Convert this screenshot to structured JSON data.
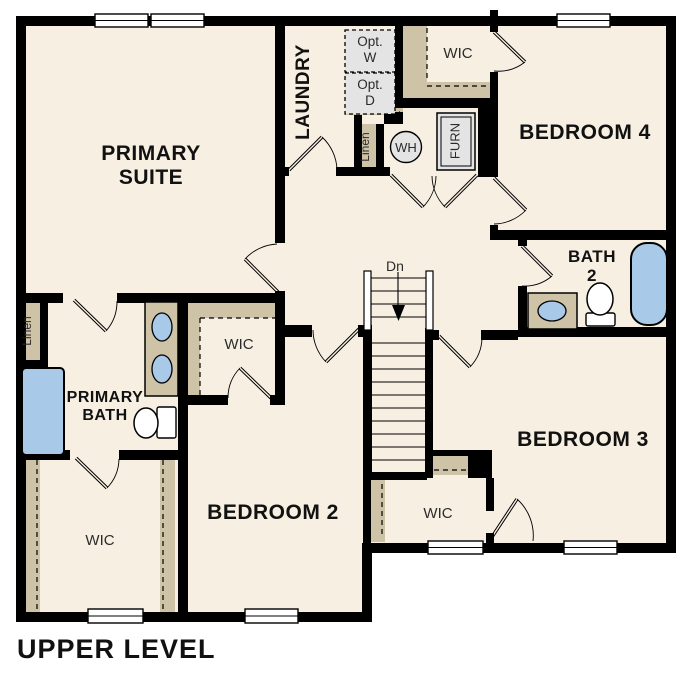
{
  "title": "UPPER LEVEL",
  "canvas": {
    "w": 687,
    "h": 687
  },
  "colors": {
    "floor": "#f7efe2",
    "wall": "#000000",
    "casework": "#cec2a7",
    "fixture_blue": "#a9c9e9",
    "appliance": "#e4e4e4",
    "label_bold": "#111111",
    "label_regular": "#2b2b2b",
    "line": "#000000",
    "white": "#ffffff"
  },
  "plan": {
    "slabs": [
      [
        16,
        16,
        660,
        537
      ],
      [
        16,
        16,
        356,
        606
      ]
    ],
    "walls": [
      [
        16,
        16,
        660,
        10
      ],
      [
        16,
        16,
        10,
        606
      ],
      [
        16,
        612,
        356,
        10
      ],
      [
        666,
        16,
        10,
        537
      ],
      [
        362,
        543,
        314,
        10
      ],
      [
        362,
        543,
        10,
        79
      ],
      [
        275,
        16,
        10,
        227
      ],
      [
        275,
        291,
        10,
        12
      ],
      [
        275,
        167,
        14,
        9
      ],
      [
        336,
        167,
        54,
        9
      ],
      [
        384,
        112,
        19,
        12
      ],
      [
        395,
        23,
        8,
        85
      ],
      [
        354,
        115,
        8,
        61
      ],
      [
        376,
        124,
        8,
        52
      ],
      [
        403,
        98,
        95,
        10
      ],
      [
        490,
        10,
        8,
        22
      ],
      [
        490,
        72,
        8,
        36
      ],
      [
        490,
        108,
        8,
        69
      ],
      [
        490,
        225,
        8,
        15
      ],
      [
        478,
        107,
        14,
        70
      ],
      [
        490,
        230,
        186,
        10
      ],
      [
        518,
        240,
        9,
        6
      ],
      [
        518,
        286,
        9,
        51
      ],
      [
        518,
        327,
        158,
        10
      ],
      [
        425,
        330,
        14,
        10
      ],
      [
        481,
        330,
        37,
        10
      ],
      [
        16,
        293,
        47,
        10
      ],
      [
        117,
        293,
        168,
        10
      ],
      [
        40,
        303,
        8,
        60
      ],
      [
        16,
        360,
        32,
        8
      ],
      [
        16,
        450,
        54,
        10
      ],
      [
        119,
        450,
        69,
        10
      ],
      [
        178,
        293,
        10,
        329
      ],
      [
        275,
        303,
        10,
        102
      ],
      [
        188,
        395,
        40,
        10
      ],
      [
        270,
        395,
        13,
        10
      ],
      [
        285,
        325,
        27,
        12
      ],
      [
        358,
        325,
        14,
        12
      ],
      [
        363,
        328,
        9,
        150
      ],
      [
        425,
        328,
        8,
        150
      ],
      [
        365,
        472,
        62,
        8
      ],
      [
        432,
        450,
        60,
        6
      ],
      [
        468,
        452,
        24,
        26
      ],
      [
        363,
        478,
        8,
        75
      ],
      [
        486,
        478,
        8,
        33
      ],
      [
        486,
        533,
        8,
        10
      ]
    ],
    "windows": [
      [
        95,
        14,
        53,
        13
      ],
      [
        151,
        14,
        53,
        13
      ],
      [
        557,
        14,
        53,
        13
      ],
      [
        88,
        609,
        55,
        14
      ],
      [
        245,
        609,
        53,
        14
      ],
      [
        428,
        541,
        55,
        13
      ],
      [
        564,
        541,
        53,
        13
      ]
    ],
    "casework": [
      [
        22,
        303,
        18,
        57
      ],
      [
        362,
        124,
        14,
        46
      ],
      [
        403,
        23,
        24,
        80
      ],
      [
        403,
        82,
        89,
        21
      ],
      [
        188,
        303,
        87,
        15
      ],
      [
        188,
        303,
        12,
        94
      ],
      [
        26,
        455,
        14,
        157
      ],
      [
        160,
        455,
        15,
        157
      ],
      [
        371,
        480,
        14,
        62
      ],
      [
        432,
        456,
        36,
        19
      ],
      [
        345,
        106,
        58,
        9
      ]
    ],
    "dashed": [
      [
        427,
        28,
        427,
        80
      ],
      [
        427,
        86,
        492,
        86
      ],
      [
        200,
        318,
        275,
        318
      ],
      [
        200,
        318,
        200,
        395
      ],
      [
        37,
        460,
        37,
        610
      ],
      [
        163,
        460,
        163,
        610
      ],
      [
        382,
        484,
        382,
        538
      ],
      [
        434,
        470,
        466,
        470
      ],
      [
        345,
        112,
        400,
        112
      ]
    ],
    "doors": [
      {
        "id": "laundry-door",
        "h": [
          289,
          170
        ],
        "t": [
          322,
          137
        ],
        "a": [
          337,
          170
        ]
      },
      {
        "id": "primary-suite-door",
        "h": [
          278,
          292
        ],
        "t": [
          245,
          259
        ],
        "a": [
          277,
          244
        ]
      },
      {
        "id": "primary-bath-door",
        "h": [
          74,
          300
        ],
        "t": [
          106,
          331
        ],
        "a": [
          117,
          301
        ]
      },
      {
        "id": "primary-wic-door",
        "h": [
          76,
          458
        ],
        "t": [
          107,
          488
        ],
        "a": [
          119,
          459
        ]
      },
      {
        "id": "bedroom2-wic-door",
        "h": [
          271,
          398
        ],
        "t": [
          240,
          368
        ],
        "a": [
          228,
          398
        ]
      },
      {
        "id": "bedroom2-door",
        "h": [
          359,
          329
        ],
        "t": [
          326,
          362
        ],
        "a": [
          313,
          330
        ]
      },
      {
        "id": "mech-door-left",
        "h": [
          391,
          175
        ],
        "t": [
          423,
          207
        ],
        "a": [
          436,
          176
        ]
      },
      {
        "id": "mech-door-right",
        "h": [
          477,
          175
        ],
        "t": [
          445,
          207
        ],
        "a": [
          432,
          176
        ]
      },
      {
        "id": "bedroom4-door",
        "h": [
          494,
          178
        ],
        "t": [
          526,
          210
        ],
        "a": [
          494,
          224
        ]
      },
      {
        "id": "bedroom4-wic-door",
        "h": [
          494,
          32
        ],
        "t": [
          525,
          62
        ],
        "a": [
          494,
          71
        ]
      },
      {
        "id": "bath2-door",
        "h": [
          522,
          246
        ],
        "t": [
          552,
          276
        ],
        "a": [
          522,
          286
        ]
      },
      {
        "id": "bedroom3-door",
        "h": [
          439,
          336
        ],
        "t": [
          470,
          367
        ],
        "a": [
          482,
          339
        ]
      },
      {
        "id": "bedroom3-wic-door",
        "h": [
          490,
          540
        ],
        "t": [
          517,
          499
        ],
        "a": [
          533,
          541
        ]
      }
    ],
    "stairs": {
      "rails": [
        [
          364,
          271,
          7,
          59
        ],
        [
          426,
          271,
          7,
          59
        ]
      ],
      "treads_top": {
        "ys": [
          278,
          291,
          304,
          317
        ],
        "x1": 371,
        "x2": 426
      },
      "divider": [
        398,
        272,
        398,
        305
      ],
      "arrow": [
        [
          392,
          305
        ],
        [
          405,
          305
        ],
        [
          398.5,
          321
        ]
      ],
      "treads": {
        "ys": [
          343,
          356,
          369,
          382,
          395,
          408,
          421,
          434,
          447,
          460
        ],
        "x1": 372,
        "x2": 425
      },
      "label": "Dn"
    },
    "fixtures": {
      "tubs": [
        {
          "id": "primary-shower",
          "r": [
            22,
            368,
            42,
            87
          ],
          "rx": 4
        },
        {
          "id": "bath2-tub",
          "r": [
            631,
            243,
            36,
            82
          ],
          "rx": 16
        }
      ],
      "vanities": [
        {
          "id": "primary-vanity",
          "r": [
            145,
            302,
            33,
            94
          ],
          "sinks": [
            [
              162,
              327,
              10,
              14
            ],
            [
              162,
              369,
              10,
              14
            ]
          ]
        },
        {
          "id": "bath2-vanity",
          "r": [
            528,
            293,
            49,
            36
          ],
          "sinks": [
            [
              552,
              311,
              14,
              10
            ]
          ]
        }
      ],
      "toilets": [
        {
          "id": "primary-toilet",
          "bowl": [
            146,
            423,
            12,
            15
          ],
          "tank": [
            157,
            407,
            19,
            31
          ]
        },
        {
          "id": "bath2-toilet",
          "bowl": [
            600,
            299,
            13,
            16
          ],
          "tank": [
            586,
            313,
            29,
            13
          ]
        }
      ]
    },
    "appliances": {
      "opt_boxes": [
        {
          "id": "optional-washer",
          "r": [
            345,
            30,
            50,
            42
          ],
          "lines": [
            "Opt.",
            "W"
          ],
          "ty": [
            46,
            62
          ]
        },
        {
          "id": "optional-dryer",
          "r": [
            345,
            73,
            50,
            41
          ],
          "lines": [
            "Opt.",
            "D"
          ],
          "ty": [
            89,
            105
          ]
        }
      ],
      "water_heater": {
        "c": [
          406,
          147
        ],
        "radius": 15.5,
        "label": "WH",
        "tx": 406,
        "ty": 152
      },
      "furnace": {
        "r": [
          437,
          113,
          38,
          57
        ],
        "label": "FURN",
        "tx": 456,
        "ty": 141
      }
    },
    "labels": [
      {
        "id": "primary-suite",
        "x": 151,
        "y": 160,
        "size": 21,
        "bold": true,
        "lh": 24,
        "lines": [
          "PRIMARY",
          "SUITE"
        ]
      },
      {
        "id": "laundry",
        "x": 309,
        "y": 92,
        "size": 19,
        "bold": true,
        "rot": true,
        "lines": [
          "LAUNDRY"
        ]
      },
      {
        "id": "wic-bedroom4",
        "x": 458,
        "y": 58,
        "size": 15,
        "lines": [
          "WIC"
        ]
      },
      {
        "id": "bedroom-4",
        "x": 585,
        "y": 139,
        "size": 21,
        "bold": true,
        "lines": [
          "BEDROOM 4"
        ]
      },
      {
        "id": "linen-hall",
        "x": 369,
        "y": 147,
        "size": 12,
        "rot": true,
        "lines": [
          "Linen"
        ]
      },
      {
        "id": "bath-2",
        "x": 592,
        "y": 262,
        "size": 17,
        "bold": true,
        "lh": 19,
        "lines": [
          "BATH",
          "2"
        ]
      },
      {
        "id": "stairs-dn",
        "x": 395,
        "y": 271,
        "size": 14,
        "lines": [
          "Dn"
        ]
      },
      {
        "id": "bedroom-3",
        "x": 583,
        "y": 446,
        "size": 21,
        "bold": true,
        "lines": [
          "BEDROOM 3"
        ]
      },
      {
        "id": "wic-bedroom3",
        "x": 438,
        "y": 518,
        "size": 15,
        "lines": [
          "WIC"
        ]
      },
      {
        "id": "bedroom-2",
        "x": 273,
        "y": 519,
        "size": 21,
        "bold": true,
        "lines": [
          "BEDROOM 2"
        ]
      },
      {
        "id": "wic-bedroom2",
        "x": 239,
        "y": 349,
        "size": 15,
        "lines": [
          "WIC"
        ]
      },
      {
        "id": "wic-primary",
        "x": 100,
        "y": 545,
        "size": 15,
        "lines": [
          "WIC"
        ]
      },
      {
        "id": "primary-bath",
        "x": 105,
        "y": 402,
        "size": 16,
        "bold": true,
        "lh": 18,
        "lines": [
          "PRIMARY",
          "BATH"
        ]
      },
      {
        "id": "linen-primary",
        "x": 31,
        "y": 331,
        "size": 12,
        "rot": true,
        "lines": [
          "Linen"
        ]
      }
    ]
  }
}
